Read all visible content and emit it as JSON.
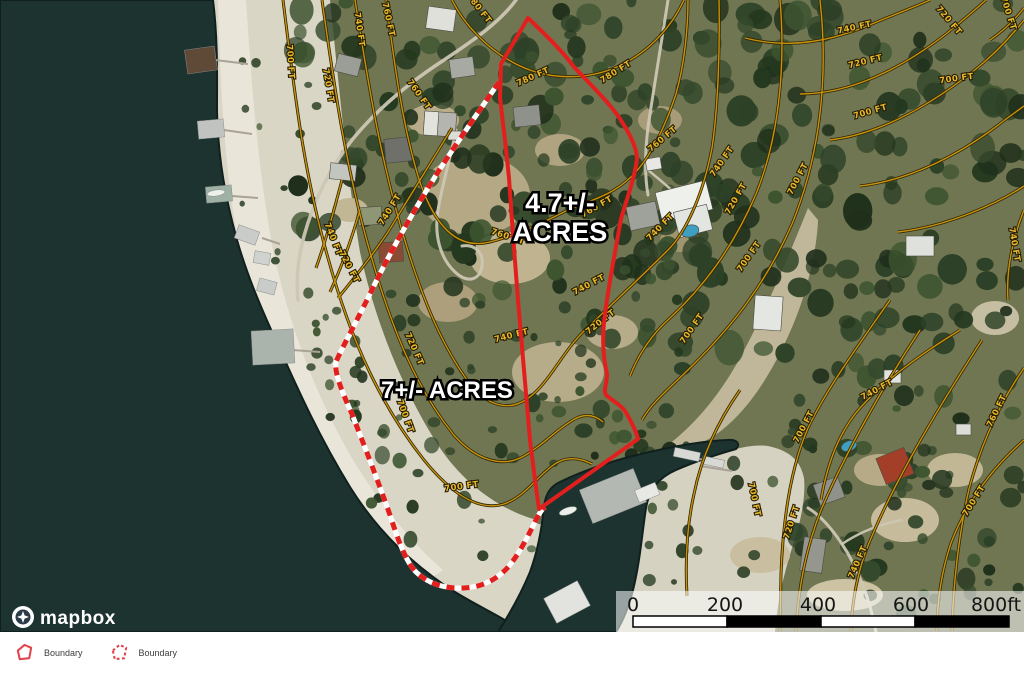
{
  "map": {
    "parcels": {
      "a": {
        "line1": "4.7+/-",
        "line2": "ACRES"
      },
      "b": {
        "label": "7+/- ACRES"
      }
    },
    "contour_labels": [
      {
        "text": "700 FT",
        "x": 288,
        "y": 62,
        "r": 86
      },
      {
        "text": "720 FT",
        "x": 326,
        "y": 86,
        "r": 80
      },
      {
        "text": "740 FT",
        "x": 357,
        "y": 30,
        "r": 82
      },
      {
        "text": "760 FT",
        "x": 386,
        "y": 20,
        "r": 78
      },
      {
        "text": "760 FT",
        "x": 417,
        "y": 96,
        "r": 55
      },
      {
        "text": "740 FT",
        "x": 331,
        "y": 240,
        "r": 68
      },
      {
        "text": "720 FT",
        "x": 347,
        "y": 268,
        "r": 62
      },
      {
        "text": "780 FT",
        "x": 477,
        "y": 10,
        "r": 52
      },
      {
        "text": "780 FT",
        "x": 534,
        "y": 79,
        "r": -24
      },
      {
        "text": "780 FT",
        "x": 617,
        "y": 74,
        "r": -32
      },
      {
        "text": "760 FT",
        "x": 598,
        "y": 209,
        "r": -30
      },
      {
        "text": "760 FT",
        "x": 507,
        "y": 239,
        "r": 18
      },
      {
        "text": "740 FT",
        "x": 392,
        "y": 211,
        "r": -58
      },
      {
        "text": "740 FT",
        "x": 590,
        "y": 287,
        "r": -28
      },
      {
        "text": "740 FT",
        "x": 512,
        "y": 338,
        "r": -14
      },
      {
        "text": "720 FT",
        "x": 602,
        "y": 324,
        "r": -38
      },
      {
        "text": "720 FT",
        "x": 412,
        "y": 350,
        "r": 66
      },
      {
        "text": "700 FT",
        "x": 403,
        "y": 417,
        "r": 70
      },
      {
        "text": "700 FT",
        "x": 462,
        "y": 489,
        "r": -8
      },
      {
        "text": "760 FT",
        "x": 664,
        "y": 141,
        "r": -40
      },
      {
        "text": "740 FT",
        "x": 724,
        "y": 163,
        "r": -55
      },
      {
        "text": "740 FT",
        "x": 662,
        "y": 229,
        "r": -45
      },
      {
        "text": "720 FT",
        "x": 738,
        "y": 200,
        "r": -60
      },
      {
        "text": "700 FT",
        "x": 800,
        "y": 180,
        "r": -62
      },
      {
        "text": "700 FT",
        "x": 751,
        "y": 258,
        "r": -55
      },
      {
        "text": "700 FT",
        "x": 694,
        "y": 330,
        "r": -55
      },
      {
        "text": "740 FT",
        "x": 855,
        "y": 30,
        "r": -12
      },
      {
        "text": "720 FT",
        "x": 947,
        "y": 22,
        "r": 50
      },
      {
        "text": "720 FT",
        "x": 866,
        "y": 64,
        "r": -14
      },
      {
        "text": "700 FT",
        "x": 957,
        "y": 81,
        "r": -8
      },
      {
        "text": "700 FT",
        "x": 871,
        "y": 114,
        "r": -16
      },
      {
        "text": "700 FT",
        "x": 1006,
        "y": 14,
        "r": 72
      },
      {
        "text": "700 FT",
        "x": 752,
        "y": 500,
        "r": 78
      },
      {
        "text": "700 FT",
        "x": 806,
        "y": 428,
        "r": -62
      },
      {
        "text": "720 FT",
        "x": 794,
        "y": 523,
        "r": -72
      },
      {
        "text": "740 FT",
        "x": 860,
        "y": 563,
        "r": -66
      },
      {
        "text": "740 FT",
        "x": 878,
        "y": 392,
        "r": -28
      },
      {
        "text": "760 FT",
        "x": 999,
        "y": 412,
        "r": -64
      },
      {
        "text": "700 FT",
        "x": 976,
        "y": 502,
        "r": -58
      },
      {
        "text": "740 FT",
        "x": 1012,
        "y": 245,
        "r": 80
      }
    ],
    "scale_bar": {
      "ticks": [
        "0",
        "200",
        "400",
        "600",
        "800ft"
      ]
    },
    "logo_text": "mapbox",
    "colors": {
      "boundary_red": "#e31f1e",
      "contour_gold": "#c8920e",
      "water": "#1d3330",
      "sand": "#dad6c6"
    }
  },
  "legend": {
    "items": [
      {
        "label": "Boundary",
        "style": "solid"
      },
      {
        "label": "Boundary",
        "style": "dashed"
      }
    ]
  }
}
